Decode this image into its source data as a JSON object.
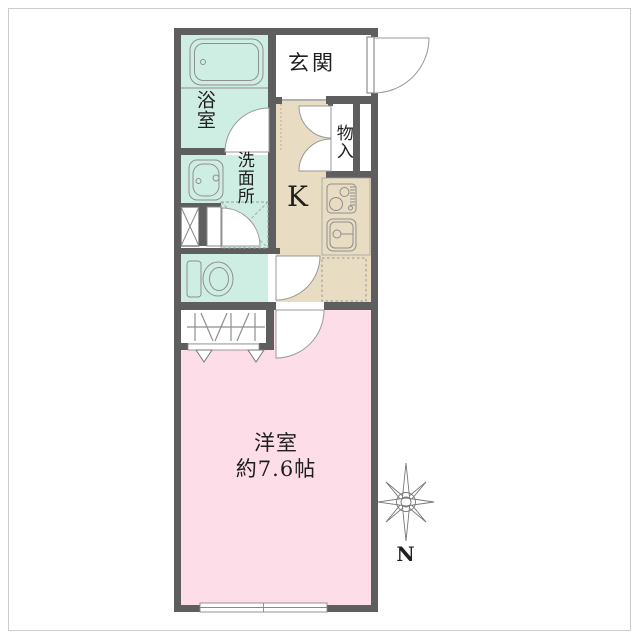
{
  "plan": {
    "rooms": {
      "bathroom": {
        "label": "浴室"
      },
      "entrance": {
        "label": "玄関"
      },
      "washroom": {
        "label": "洗面所"
      },
      "storage": {
        "label": "物入"
      },
      "kitchen": {
        "label": "K"
      },
      "western_room": {
        "label": "洋室",
        "size": "約7.6帖"
      }
    },
    "compass": {
      "north_label": "N"
    }
  },
  "colors": {
    "wall": "#5e5e5e",
    "mint": "#cfeee3",
    "beige": "#e8dcc2",
    "pink": "#fcdde8",
    "text": "#1f1f1f"
  }
}
